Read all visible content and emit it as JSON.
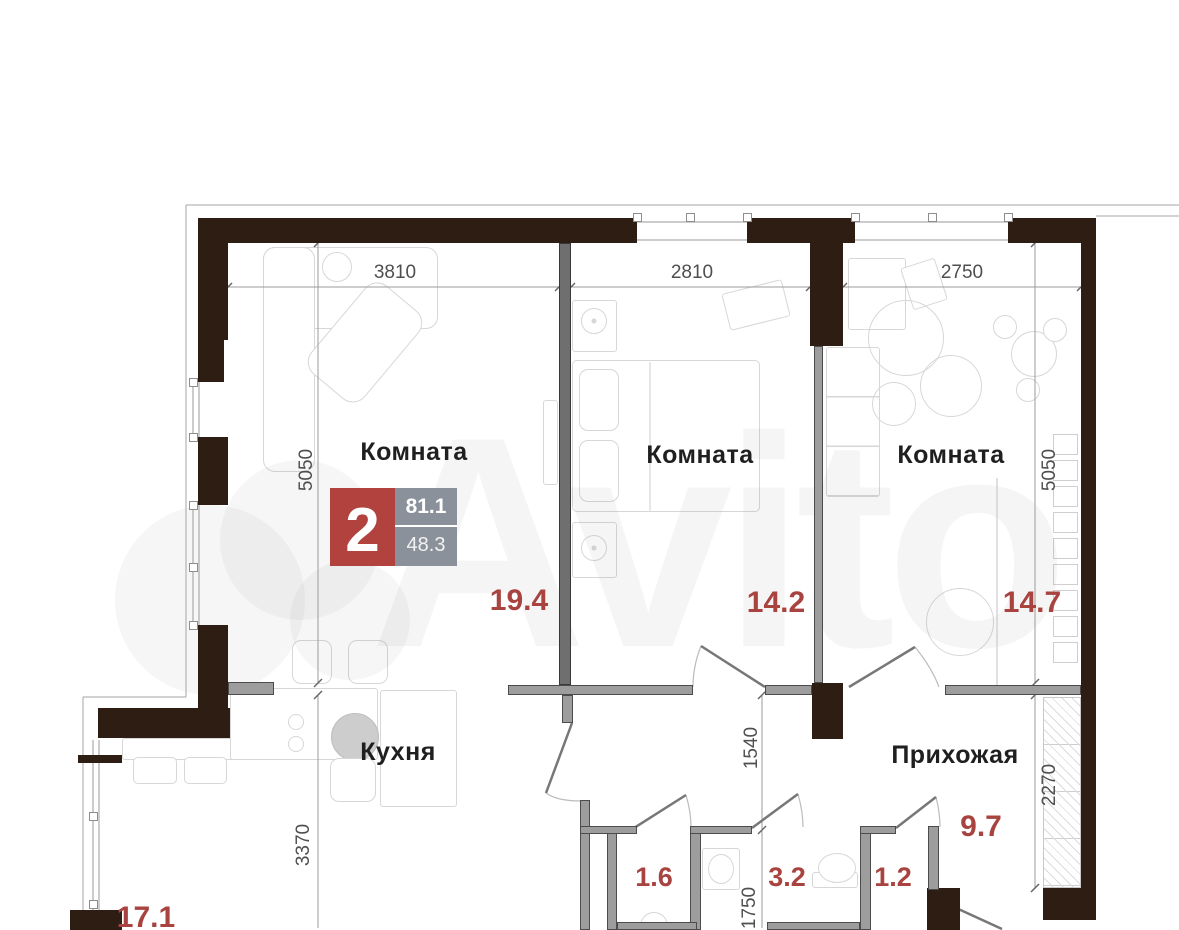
{
  "watermark": {
    "text": "Avito"
  },
  "badge": {
    "rooms_count": "2",
    "total_area": "81.1",
    "living_area": "48.3"
  },
  "rooms": {
    "room1": {
      "label": "Комната",
      "area": "19.4",
      "width_mm": "3810",
      "height_mm": "5050"
    },
    "room2": {
      "label": "Комната",
      "area": "14.2",
      "width_mm": "2810"
    },
    "room3": {
      "label": "Комната",
      "area": "14.7",
      "width_mm": "2750",
      "height_mm": "5050"
    },
    "kitchen": {
      "label": "Кухня",
      "area": "17.1",
      "height_mm": "3370"
    },
    "hallway": {
      "label": "Прихожая",
      "area": "9.7",
      "height_mm": "1540",
      "closet_height_mm": "2270"
    },
    "storage": {
      "area": "1.6"
    },
    "bathroom": {
      "area": "3.2",
      "height_mm": "1750"
    },
    "wc": {
      "area": "1.2"
    }
  },
  "colors": {
    "exterior_wall": "#2e1d12",
    "interior_wall": "#9d9d9d",
    "accent_red": "#a84340",
    "badge_red": "#b2423e",
    "badge_gray": "#8b919b",
    "dimension_text": "#4f4f4f",
    "label_text": "#1f1f1f",
    "furniture_line": "#d7d7d7"
  }
}
